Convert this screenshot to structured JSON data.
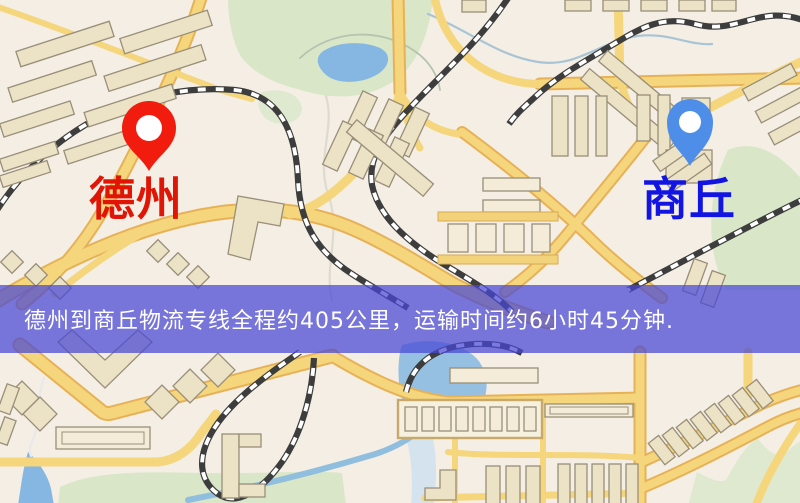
{
  "banner": {
    "text": "德州到商丘物流专线全程约405公里，运输时间约6小时45分钟."
  },
  "markers": {
    "origin": {
      "label": "德州",
      "pin_icon": "red-location-pin-icon"
    },
    "destination": {
      "label": "商丘",
      "pin_icon": "blue-location-pin-icon"
    }
  },
  "colors": {
    "map-bg": "#f4eee4",
    "road-fill": "#f5d67c",
    "road-casing": "#e7b257",
    "railway": "#3d3d3d",
    "building-fill": "#ece2c6",
    "building-stroke": "#998f79",
    "park": "#d9e6c8",
    "water": "#85b7e2",
    "banner-overlay": "rgba(70,70,214,0.72)",
    "banner-text": "#ffffff",
    "origin-pin": "#f11b0e",
    "origin-label": "#e01505",
    "destination-pin": "#4e8ee9",
    "destination-label": "#1215e2"
  }
}
